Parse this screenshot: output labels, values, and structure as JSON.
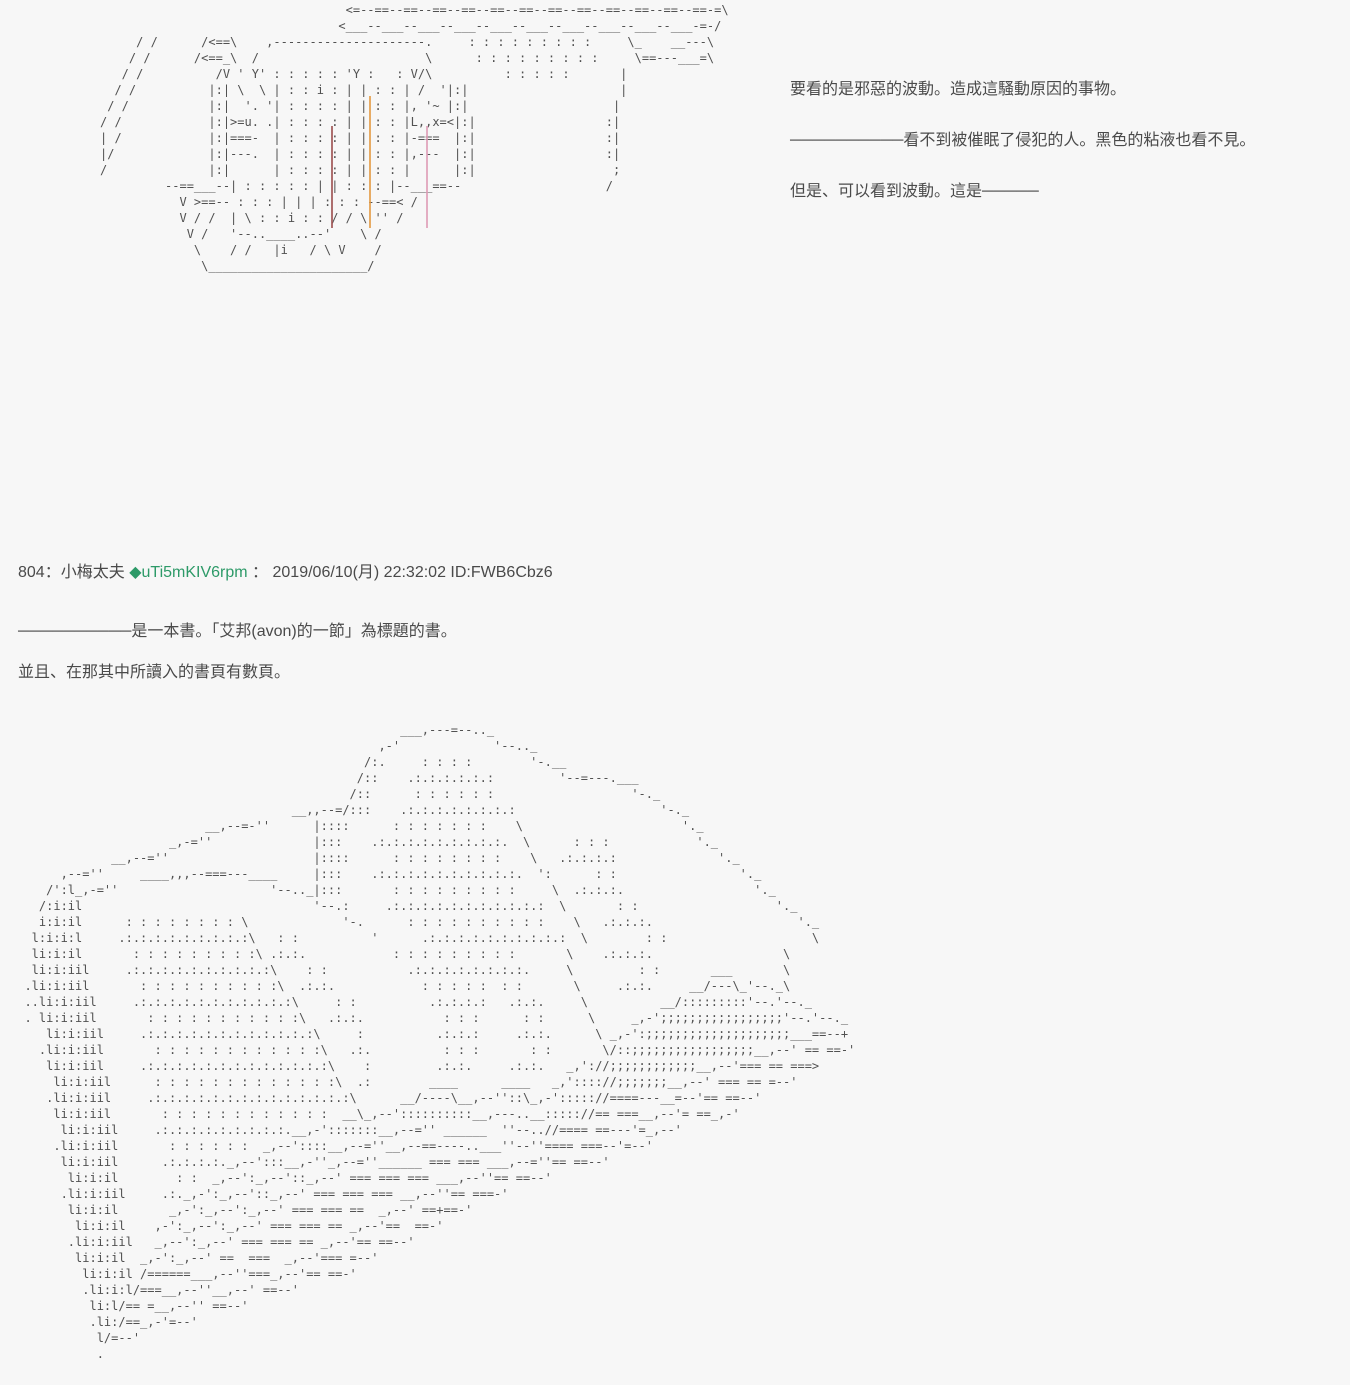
{
  "page": {
    "background": "#f7f7f7",
    "text_color": "#4a4a4a",
    "aa_color": "#515151"
  },
  "dialogue": {
    "lines": [
      "要看的是邪惡的波動。造成這騷動原因的事物。",
      "──────────看不到被催眠了侵犯的人。黑色的粘液也看不見。",
      "但是、可以看到波動。這是─────"
    ]
  },
  "post": {
    "number": "804",
    "sep1": "：",
    "name": "小梅太夫",
    "tripcode": "◆uTi5mKIV6rpm",
    "sep2": " ： ",
    "datetime": "2019/06/10(月) 22:32:02",
    "id": "ID:FWB6Cbz6",
    "tripcode_color": "#2d9a68"
  },
  "body": {
    "lines": [
      "──────────是一本書。「艾邦(avon)的一節」為標題的書。",
      "並且、在那其中所讀入的書頁有數頁。"
    ]
  },
  "decorations": {
    "colors": {
      "maroon": "#9a4b4b",
      "orange": "#e2973f",
      "pink": "#dd9ab4"
    }
  },
  "ascii_art": {
    "top_description": "aa-character-face",
    "book_description": "aa-open-book",
    "top_lines": [
      "                                  <=--==--==--==--==--==--==--==--==--==--==--==--==-=\\",
      "                                 <___--___--___--___--___--___--___--___--___--___-=-/",
      "     / /      /<==\\    ,---------------------.     : : : : : : : : :     \\_    __---\\",
      "    / /      /<==_\\  /                       \\      : : : : : : : : :     \\==---___=\\",
      "   / /          /V ' Y' : : : : : 'Y :   : V/\\          : : : : :       |",
      "  / /          |:| \\  \\ | : : i : | | : : | /  '|:|                     |",
      " / /           |:|  '. '| : : : : | | : : |, '~ |:|                    |",
      "/ /            |:|>=u. .| : : : : | | : : |L,,x=<|:|                  :|",
      "| /            |:|===-  | : : : : | | : : |-===  |:|                  :|",
      "|/             |:|---.  | : : : : | | : : |,---  |:|                  :|",
      "/              |:|      | : : : : | | : : |      |:|                   ;",
      "         --==___--| : : : : : | | : : : |--___==--                    /",
      "           V >==-- : : : | | | : : : --==< /",
      "           V / /  | \\ : : i : : / / \\ '' /",
      "            V /   '--..____..--'    \\ /",
      "             \\    / /   |i   / \\ V    /",
      "              \\______________________/"
    ],
    "book_lines": [
      "                                                      ___,---=--.._",
      "                                                   ,-'             '--.._",
      "                                                 /:.     : : : :        '-.__",
      "                                                /::    .:.:.:.:.:.:         '--=---.___",
      "                                               /::      : : : : : :                   '-._",
      "                                       __,,--=/:::    .:.:.:.:.:.:.:.:                    '-._",
      "                           __,--=-''      |::::      : : : : : : :    \\                      '._",
      "                      _,-=''              |:::    .:.:.:.:.:.:.:.:.:.  \\      : : :            '._",
      "              __,--=''                    |::::      : : : : : : : :    \\   .:.:.:.:              '._",
      "       ,--=''     ____,,,--===---____     |:::    .:.:.:.:.:.:.:.:.:.:.  ':      : :                 '._",
      "     /':l_,-=''                     '--.._|:::       : : : : : : : : :     \\  .:.:.:.                  '._",
      "    /:i:il                                '--.:     .:.:.:.:.:.:.:.:.:.:.:  \\       : :                   '._",
      "    i:i:il      : : : : : : : : \\             '-.      : : : : : : : : : :    \\   .:.:.:.                    '._",
      "   l:i:i:l     .:.:.:.:.:.:.:.:.:\\   : :          '      .:.:.:.:.:.:.:.:.:.:  \\        : :                    \\",
      "   li:i:il       : : : : : : : : :\\ .:.:.            : : : : : : : : :       \\    .:.:.:.                  \\",
      "   li:i:iil     .:.:.:.:.:.:.:.:.:.:\\    : :           .:.:.:.:.:.:.:.:.     \\         : :       ___       \\",
      "  .li:i:iil       : : : : : : : : : :\\  .:.:.            : : : : :  : :       \\     .:.:.     __/---\\_'--._\\",
      "  ..li:i:iil     .:.:.:.:.:.:.:.:.:.:.:\\     : :          .:.:.:.:   .:.:.     \\          __/:::::::::'--.'--._",
      "  . li:i:iil       : : : : : : : : : : :\\   .:.:.           : : :      : :      \\     _,-';;;;;;;;;;;;;;;;;'--.'--._",
      "     li:i:iil     .:.:.:.:.:.:.:.:.:.:.:.:\\     :          .:.:.:     .:.:.      \\ _,-':;;;;;;;;;;;;;;;;;;;;___==--+",
      "    .li:i:iil       : : : : : : : : : : : :\\   .:.          : : :       : :       \\/::;;;;;;;;;;;;;;;;;__,--' == ==-'",
      "     li:i:iil     .:.:.:.:.:.:.:.:.:.:.:.:.:\\    :         .:.:.     .:.:.   _,'://;;;;;;;;;;;;__,--'=== == ===>",
      "      li:i:iil      : : : : : : : : : : : : :\\  .:        ____      ____   _,':::://;;;;;;;__,--' === == =--'",
      "     .li:i:iil     .:.:.:.:.:.:.:.:.:.:.:.:.:.:\\      __/----\\__,--''::\\_,-'::::://====---__=--'== ==--'",
      "      li:i:iil       : : : : : : : : : : : :  __\\_,--'::::::::::__,---..__::::://== ===__,--'= ==_,-'",
      "       li:i:iil     .:.:.:.:.:.:.:.:.:.__,-':::::::__,--='' ______  ''--..//==== ==---'=_,--'",
      "      .li:i:iil       : : : : : :  _,--'::::__,--=''__,--==----..___''--''==== ===--'=--'",
      "       li:i:iil      .:.:.:.:._,--':::__,-''_,--=''______ === === ___,--=''== ==--'",
      "        li:i:il        : :  _,--':_,--'::_,--' === === === ___,--''== ==--'",
      "       .li:i:iil     .:._,-':_,--'::_,--' === === === __,--''== ===-'",
      "        li:i:il       _,-':_,--':_,--' === === ==  _,--' ==+==-'",
      "         li:i:il    ,-':_,--':_,--' === === == _,--'==  ==-'",
      "        .li:i:iil   _,--':_,--' === === == _,--'== ==--'",
      "         li:i:il  _,-':_,--' ==  ===  _,--'=== =--'",
      "          li:i:il /======___,--''===_,--'== ==-'",
      "          .li:i:l/===__,--''__,--' ==--'",
      "           li:l/== =__,--'' ==--'",
      "           .li:/==_,-'=--'",
      "            l/=--'",
      "            ."
    ]
  }
}
